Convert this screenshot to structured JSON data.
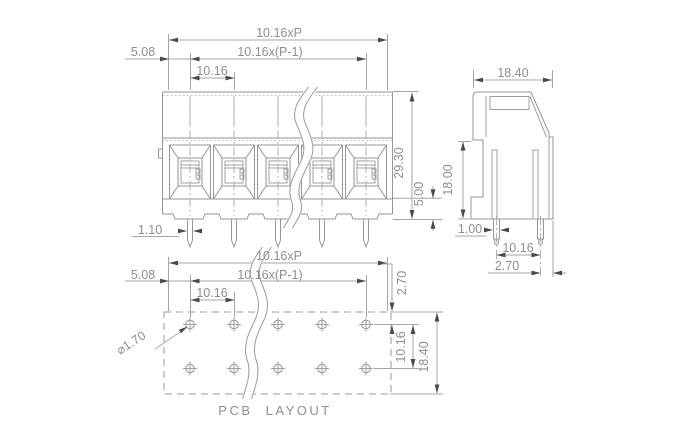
{
  "drawing": {
    "title": "terminal-block-dimension-drawing",
    "colors": {
      "background": "#ffffff",
      "line": "#969696",
      "dimension_line": "#a6a6a6",
      "arrow": "#4a4a4a",
      "text": "#8e8e8e"
    },
    "front": {
      "dim_total": "10.16xP",
      "dim_span": "10.16x(P-1)",
      "dim_pitch": "10.16",
      "dim_half_pitch": "5.08",
      "dim_pin_width": "1.10",
      "dim_height": "29.30",
      "dim_base_height": "5.00"
    },
    "side": {
      "dim_width": "18.40",
      "dim_body_height": "18.00",
      "dim_pin_width": "1.00",
      "dim_pin_spacing": "10.16",
      "dim_edge_offset": "2.70"
    },
    "pcb": {
      "label": "PCB LAYOUT",
      "dim_total": "10.16xP",
      "dim_span": "10.16x(P-1)",
      "dim_pitch": "10.16",
      "dim_half_pitch": "5.08",
      "dim_hole_diameter": "⌀1.70",
      "dim_edge_offset": "2.70",
      "dim_row_spacing": "10.16",
      "dim_height": "18.40"
    }
  }
}
